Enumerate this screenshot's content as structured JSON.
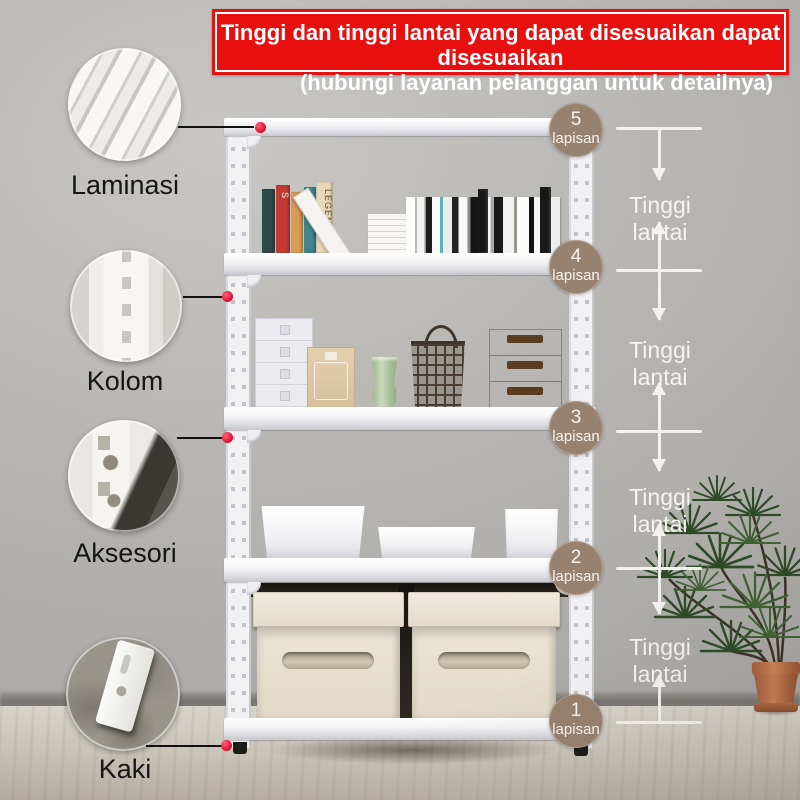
{
  "banner": {
    "line1": "Tinggi dan tinggi lantai yang dapat disesuaikan dapat disesuaikan",
    "line2": "(hubungi layanan pelanggan untuk detailnya)"
  },
  "callouts": [
    {
      "label": "Laminasi"
    },
    {
      "label": "Kolom"
    },
    {
      "label": "Aksesori"
    },
    {
      "label": "Kaki"
    }
  ],
  "levels": [
    {
      "number": "5",
      "unit": "lapisan"
    },
    {
      "number": "4",
      "unit": "lapisan"
    },
    {
      "number": "3",
      "unit": "lapisan"
    },
    {
      "number": "2",
      "unit": "lapisan"
    },
    {
      "number": "1",
      "unit": "lapisan"
    }
  ],
  "gap_labels": [
    "Tinggi lantai",
    "Tinggi lantai",
    "Tinggi lantai",
    "Tinggi lantai"
  ],
  "books": {
    "legend_spine": "LEGEND",
    "red_spine": "S"
  },
  "colors": {
    "banner_red": "#e80f0f",
    "badge_brown": "#97816f",
    "marker_dot_red": "#e01535",
    "annotation_white": "#f3f2ef",
    "wall_gray": "#b5b3b0"
  }
}
